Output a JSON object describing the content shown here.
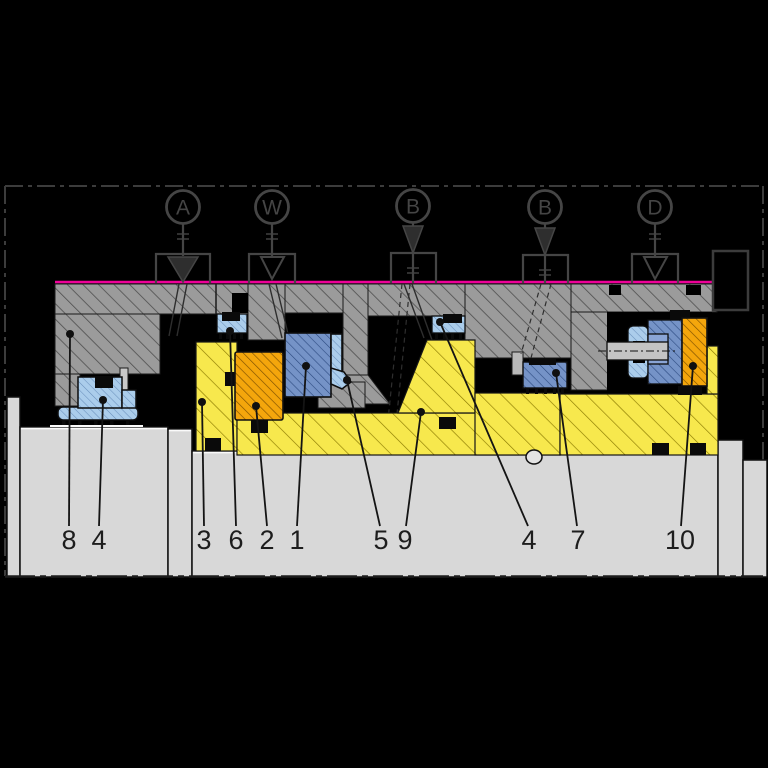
{
  "drawing": {
    "kind": "mechanical-seal-cross-section",
    "ports": [
      {
        "id": "port-a",
        "label": "A",
        "symbol": "filled-triangle"
      },
      {
        "id": "port-w",
        "label": "W",
        "symbol": "open-triangle"
      },
      {
        "id": "port-b1",
        "label": "B",
        "symbol": "filled-triangle"
      },
      {
        "id": "port-b2",
        "label": "B",
        "symbol": "filled-triangle"
      },
      {
        "id": "port-d",
        "label": "D",
        "symbol": "open-triangle"
      }
    ],
    "part_labels": [
      "8",
      "4",
      "3",
      "6",
      "2",
      "1",
      "5",
      "9",
      "4",
      "7",
      "10"
    ],
    "colors": {
      "background": "#000000",
      "housing_gray": "#9b9b9b",
      "shaft_gray": "#d8d8d8",
      "sleeve_yellow": "#f7e84d",
      "seat_orange": "#f4a60c",
      "ring_blue": "#7593c7",
      "elastomer_light_blue": "#abcdeb",
      "face_line_magenta": "#ee0098",
      "outline": "#141414"
    }
  }
}
